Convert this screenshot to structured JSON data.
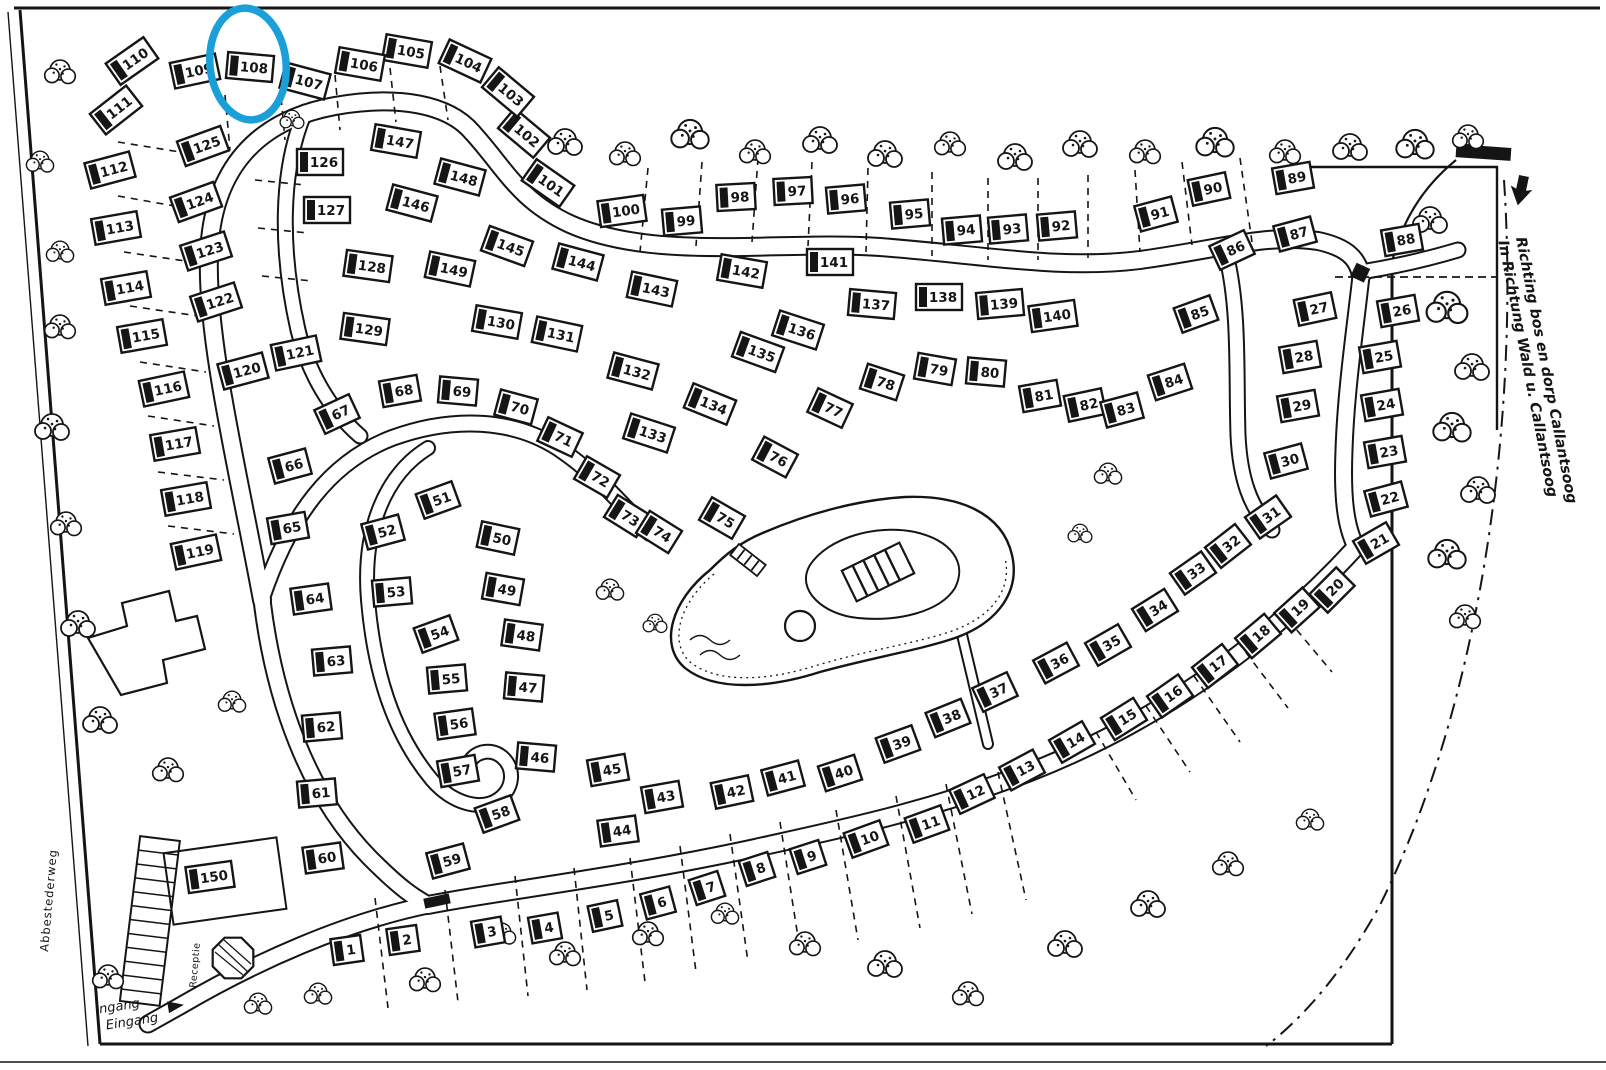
{
  "map": {
    "direction_sign": {
      "line1": "Richting bos en dorp Callantsoog",
      "line2": "In Richtung Wald u. Callantsoog"
    },
    "entrance_label": {
      "line1": "Ingang",
      "line2": "Eingang"
    },
    "street_label": "Abbestederweg",
    "reception_label": "Receptie",
    "highlight": {
      "plot": "108",
      "color": "#1a9fd9"
    },
    "plots": [
      [
        1,
        347,
        950,
        -8
      ],
      [
        2,
        403,
        940,
        -8
      ],
      [
        3,
        488,
        932,
        -10
      ],
      [
        4,
        545,
        928,
        -10
      ],
      [
        5,
        605,
        916,
        -12
      ],
      [
        6,
        658,
        903,
        -15
      ],
      [
        7,
        707,
        888,
        -18
      ],
      [
        8,
        757,
        869,
        -18
      ],
      [
        9,
        808,
        857,
        -18
      ],
      [
        10,
        866,
        839,
        -20
      ],
      [
        11,
        927,
        824,
        -20
      ],
      [
        12,
        972,
        794,
        -25
      ],
      [
        13,
        1022,
        770,
        -28
      ],
      [
        14,
        1072,
        742,
        -30
      ],
      [
        15,
        1124,
        719,
        -32
      ],
      [
        16,
        1170,
        696,
        -35
      ],
      [
        17,
        1215,
        666,
        -38
      ],
      [
        18,
        1258,
        636,
        -40
      ],
      [
        19,
        1297,
        610,
        -42
      ],
      [
        20,
        1332,
        590,
        -45
      ],
      [
        21,
        1376,
        543,
        -30
      ],
      [
        22,
        1386,
        499,
        -15
      ],
      [
        23,
        1385,
        452,
        -10
      ],
      [
        24,
        1382,
        405,
        -10
      ],
      [
        25,
        1380,
        357,
        -10
      ],
      [
        26,
        1398,
        311,
        -10
      ],
      [
        27,
        1315,
        309,
        -12
      ],
      [
        28,
        1300,
        357,
        -10
      ],
      [
        29,
        1298,
        406,
        -10
      ],
      [
        30,
        1286,
        461,
        -15
      ],
      [
        31,
        1268,
        517,
        -35
      ],
      [
        32,
        1228,
        546,
        -38
      ],
      [
        33,
        1193,
        573,
        -35
      ],
      [
        34,
        1155,
        610,
        -32
      ],
      [
        35,
        1108,
        645,
        -30
      ],
      [
        36,
        1056,
        663,
        -28
      ],
      [
        37,
        995,
        692,
        -25
      ],
      [
        38,
        948,
        718,
        -22
      ],
      [
        39,
        898,
        744,
        -20
      ],
      [
        40,
        840,
        773,
        -18
      ],
      [
        41,
        783,
        778,
        -15
      ],
      [
        42,
        732,
        792,
        -12
      ],
      [
        43,
        662,
        797,
        -10
      ],
      [
        44,
        618,
        831,
        -8
      ],
      [
        45,
        608,
        770,
        -10
      ],
      [
        46,
        536,
        757,
        5
      ],
      [
        47,
        524,
        687,
        5
      ],
      [
        48,
        522,
        635,
        8
      ],
      [
        49,
        503,
        589,
        10
      ],
      [
        50,
        498,
        538,
        12
      ],
      [
        51,
        438,
        500,
        -20
      ],
      [
        52,
        383,
        532,
        -15
      ],
      [
        53,
        392,
        592,
        -5
      ],
      [
        54,
        436,
        634,
        -20
      ],
      [
        55,
        447,
        679,
        -5
      ],
      [
        56,
        455,
        724,
        -8
      ],
      [
        57,
        458,
        771,
        -10
      ],
      [
        58,
        497,
        814,
        -20
      ],
      [
        59,
        448,
        861,
        -15
      ],
      [
        60,
        323,
        858,
        -8
      ],
      [
        61,
        317,
        793,
        -5
      ],
      [
        62,
        322,
        727,
        -5
      ],
      [
        63,
        332,
        661,
        -5
      ],
      [
        64,
        311,
        599,
        -8
      ],
      [
        65,
        288,
        528,
        -10
      ],
      [
        66,
        290,
        466,
        -15
      ],
      [
        67,
        337,
        414,
        -25
      ],
      [
        68,
        400,
        391,
        -10
      ],
      [
        69,
        458,
        391,
        5
      ],
      [
        70,
        516,
        407,
        15
      ],
      [
        71,
        560,
        437,
        25
      ],
      [
        72,
        597,
        477,
        30
      ],
      [
        73,
        627,
        516,
        32
      ],
      [
        74,
        659,
        532,
        32
      ],
      [
        75,
        722,
        518,
        30
      ],
      [
        76,
        775,
        457,
        28
      ],
      [
        77,
        830,
        408,
        25
      ],
      [
        78,
        882,
        382,
        18
      ],
      [
        79,
        935,
        369,
        10
      ],
      [
        80,
        986,
        372,
        5
      ],
      [
        81,
        1040,
        396,
        -10
      ],
      [
        82,
        1085,
        405,
        -12
      ],
      [
        83,
        1122,
        410,
        -15
      ],
      [
        84,
        1170,
        382,
        -18
      ],
      [
        85,
        1196,
        314,
        -20
      ],
      [
        86,
        1232,
        250,
        -25
      ],
      [
        87,
        1295,
        234,
        -15
      ],
      [
        88,
        1402,
        240,
        -10
      ],
      [
        89,
        1293,
        178,
        -10
      ],
      [
        90,
        1209,
        189,
        -12
      ],
      [
        91,
        1156,
        214,
        -15
      ],
      [
        92,
        1057,
        226,
        -5
      ],
      [
        93,
        1008,
        229,
        -5
      ],
      [
        94,
        962,
        230,
        -5
      ],
      [
        95,
        910,
        214,
        -5
      ],
      [
        96,
        846,
        199,
        -5
      ],
      [
        97,
        793,
        191,
        -3
      ],
      [
        98,
        736,
        197,
        -3
      ],
      [
        99,
        682,
        221,
        -5
      ],
      [
        100,
        622,
        211,
        -8
      ],
      [
        101,
        548,
        183,
        35
      ],
      [
        102,
        524,
        133,
        40
      ],
      [
        103,
        508,
        92,
        40
      ],
      [
        104,
        465,
        61,
        25
      ],
      [
        105,
        407,
        51,
        10
      ],
      [
        106,
        360,
        64,
        10
      ],
      [
        107,
        305,
        81,
        15
      ],
      [
        108,
        250,
        67,
        5
      ],
      [
        109,
        195,
        71,
        -12
      ],
      [
        110,
        132,
        61,
        -35
      ],
      [
        111,
        116,
        110,
        -38
      ],
      [
        112,
        110,
        170,
        -15
      ],
      [
        113,
        116,
        228,
        -10
      ],
      [
        114,
        126,
        288,
        -10
      ],
      [
        115,
        142,
        336,
        -10
      ],
      [
        116,
        164,
        389,
        -12
      ],
      [
        117,
        175,
        444,
        -10
      ],
      [
        118,
        186,
        499,
        -10
      ],
      [
        119,
        196,
        552,
        -12
      ],
      [
        120,
        243,
        371,
        -15
      ],
      [
        121,
        296,
        353,
        -12
      ],
      [
        122,
        216,
        302,
        -18
      ],
      [
        123,
        206,
        251,
        -18
      ],
      [
        124,
        196,
        202,
        -20
      ],
      [
        125,
        203,
        146,
        -20
      ],
      [
        126,
        320,
        162,
        0
      ],
      [
        127,
        327,
        210,
        0
      ],
      [
        128,
        368,
        266,
        8
      ],
      [
        129,
        365,
        329,
        8
      ],
      [
        130,
        497,
        322,
        10
      ],
      [
        131,
        557,
        334,
        12
      ],
      [
        132,
        633,
        371,
        15
      ],
      [
        133,
        649,
        433,
        18
      ],
      [
        134,
        710,
        404,
        22
      ],
      [
        135,
        758,
        352,
        20
      ],
      [
        136,
        798,
        330,
        18
      ],
      [
        137,
        872,
        304,
        5
      ],
      [
        138,
        939,
        297,
        0
      ],
      [
        139,
        1000,
        304,
        -5
      ],
      [
        140,
        1053,
        316,
        -8
      ],
      [
        141,
        830,
        262,
        0
      ],
      [
        142,
        742,
        271,
        10
      ],
      [
        143,
        652,
        289,
        12
      ],
      [
        144,
        578,
        262,
        15
      ],
      [
        145,
        507,
        246,
        20
      ],
      [
        146,
        412,
        203,
        15
      ],
      [
        147,
        396,
        141,
        10
      ],
      [
        148,
        460,
        177,
        15
      ],
      [
        149,
        450,
        269,
        12
      ],
      [
        150,
        210,
        877,
        -8
      ]
    ]
  }
}
